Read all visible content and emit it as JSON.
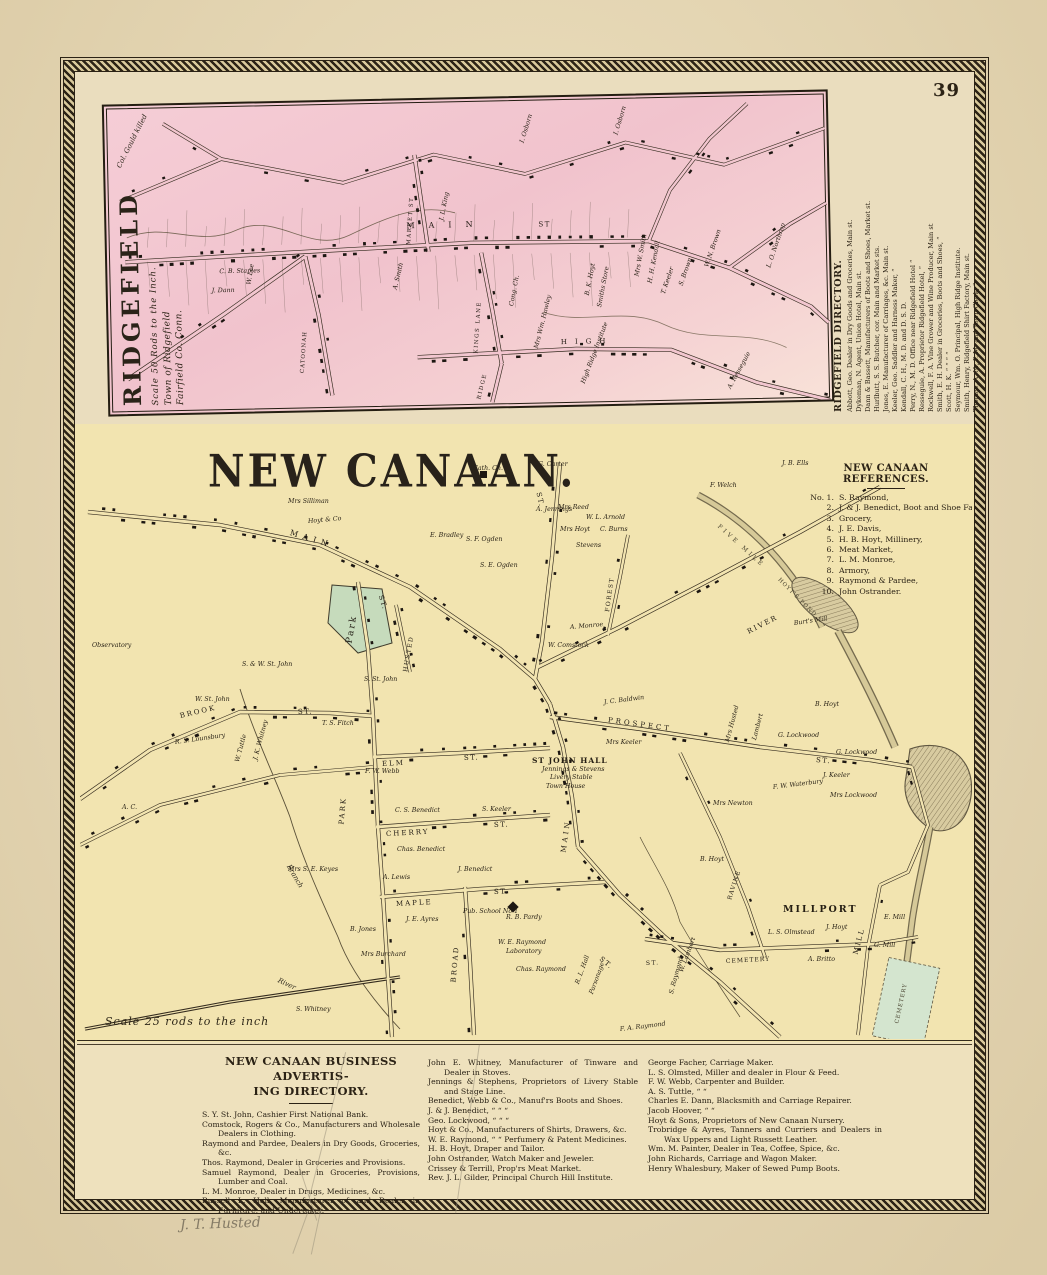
{
  "page": {
    "number": "39",
    "pencil_note": "J. T. Husted"
  },
  "colors": {
    "paper": "#e9dab6",
    "map_cream": "#f2e4b0",
    "ridgefield_pink": "#f2c6cf",
    "ink": "#2b2215",
    "park_green": "#c6dbbc",
    "pond_tan": "#d8cba0",
    "cemetery_green": "#d4e5cf"
  },
  "ridgefield": {
    "title": "RIDGEFIELD",
    "scale_note": "Scale 50 Rods to the Inch.",
    "town_note_line1": "Town of Ridgefield",
    "town_note_line2": "Fairfield Co. Conn.",
    "directory": {
      "title": "RIDGEFIELD DIRECTORY.",
      "entries": [
        "Abbott, Geo. Dealer in Dry Goods and Groceries, Main st.",
        "Dykeman, N. Agent, Union Hotel, Main st.",
        "Dann & Bassett, Manufacturers of Boots and Shoes, Market st.",
        "Hurlbutt, S. S. Butcher, cor. Main and Market sts.",
        "Jones, E. Manufacturer of Carriages, &c. Main st.",
        "Keeler, Geo. Saddler and Harness Maker,  “",
        "Kendall, C. H., M. D. and D. S. D.",
        "Perry, N., M. D. Office near Ridgefield Hotel  “",
        "Resseguie, A. Proprietor Ridgefield Hotel,  “",
        "Rockwell, F. A. Vine Grower and Wine Producer, Main st",
        "Smith, E. H. Dealer in Groceries, Boots and Shoes,  “",
        "Scott, H. K.  “  “  “  “",
        "Seymour, Wm. O. Principal, High Ridge Institute.",
        "Smith, Henry, Ridgefield Shirt Factory, Main st.",
        "Thomas, A. N., P. M. and Town Clerk,  “"
      ]
    },
    "labels": [
      {
        "t": "MAIN",
        "x": 300,
        "y": 122,
        "ls": 14,
        "s": 8,
        "k": "s"
      },
      {
        "t": "ST",
        "x": 432,
        "y": 124,
        "s": 7,
        "k": "s"
      },
      {
        "t": "MARKET ST",
        "x": 303,
        "y": 142,
        "a": -85,
        "s": 5.5,
        "k": "s"
      },
      {
        "t": "CATOONAH",
        "x": 194,
        "y": 268,
        "a": -85,
        "s": 5.5,
        "ls": 1,
        "k": "s"
      },
      {
        "t": "KINGS LANE",
        "x": 368,
        "y": 252,
        "a": -85,
        "s": 5.5,
        "k": "s"
      },
      {
        "t": "HIGH",
        "x": 452,
        "y": 242,
        "s": 7,
        "ls": 8,
        "k": "s"
      },
      {
        "t": "RIDGE",
        "x": 370,
        "y": 298,
        "a": -75,
        "s": 5.5,
        "k": "s"
      },
      {
        "t": "Col. Gould killed",
        "x": 14,
        "y": 58,
        "a": -62,
        "s": 7,
        "k": "c"
      },
      {
        "t": "I. Osborn",
        "x": 418,
        "y": 42,
        "a": -72,
        "k": "p"
      },
      {
        "t": "I. Osborn",
        "x": 512,
        "y": 36,
        "a": -72,
        "k": "p"
      },
      {
        "t": "W. Lee",
        "x": 142,
        "y": 178,
        "a": -80,
        "k": "p"
      },
      {
        "t": "A. Smith",
        "x": 288,
        "y": 186,
        "a": -75,
        "k": "p"
      },
      {
        "t": "C. B. Staples",
        "x": 112,
        "y": 165,
        "k": "p"
      },
      {
        "t": "J. Dann",
        "x": 104,
        "y": 184,
        "k": "p"
      },
      {
        "t": "J. L. King",
        "x": 336,
        "y": 118,
        "a": -78,
        "k": "p"
      },
      {
        "t": "Cong. Ch.",
        "x": 404,
        "y": 205,
        "a": -78,
        "k": "p"
      },
      {
        "t": "Mrs Wm. Hawley",
        "x": 428,
        "y": 248,
        "a": -75,
        "k": "p"
      },
      {
        "t": "Mrs W. Smith",
        "x": 530,
        "y": 178,
        "a": -78,
        "k": "p"
      },
      {
        "t": "H. H. Kendall",
        "x": 543,
        "y": 185,
        "a": -78,
        "k": "p"
      },
      {
        "t": "T. Keeler",
        "x": 556,
        "y": 196,
        "a": -70,
        "k": "p"
      },
      {
        "t": "S. Brown",
        "x": 574,
        "y": 188,
        "a": -70,
        "k": "p"
      },
      {
        "t": "B. K. Hoyt",
        "x": 480,
        "y": 196,
        "a": -78,
        "k": "p"
      },
      {
        "t": "Smiths Store",
        "x": 492,
        "y": 208,
        "a": -78,
        "k": "p"
      },
      {
        "t": "W. N. Brown",
        "x": 600,
        "y": 170,
        "a": -70,
        "k": "p"
      },
      {
        "t": "L. O. Northrop",
        "x": 662,
        "y": 172,
        "a": -70,
        "k": "p"
      },
      {
        "t": "High Ridge Institute",
        "x": 474,
        "y": 284,
        "a": -68,
        "k": "p"
      },
      {
        "t": "A. Resseguie",
        "x": 620,
        "y": 292,
        "a": -60,
        "k": "p"
      }
    ]
  },
  "new_canaan": {
    "title": "NEW CANAAN.",
    "scale_note": "Scale 25 rods to the inch",
    "references": {
      "title": "NEW CANAAN REFERENCES.",
      "entries": [
        [
          "No. 1.",
          "S. Raymond,"
        ],
        [
          "2.",
          "J. & J. Benedict, Boot and Shoe Factory."
        ],
        [
          "3.",
          "Grocery,"
        ],
        [
          "4.",
          "J. E. Davis,"
        ],
        [
          "5.",
          "H. B. Hoyt, Millinery,"
        ],
        [
          "6.",
          "Meat Market,"
        ],
        [
          "7.",
          "L. M. Monroe,"
        ],
        [
          "8.",
          "Armory,"
        ],
        [
          "9.",
          "Raymond & Pardee,"
        ],
        [
          "10.",
          "John Ostrander."
        ]
      ]
    },
    "labels": [
      {
        "t": "MAIN",
        "x": 210,
        "y": 112,
        "a": 17,
        "s": 8,
        "ls": 5,
        "k": "s"
      },
      {
        "t": "ST.",
        "x": 300,
        "y": 175,
        "a": 72,
        "s": 7,
        "k": "s"
      },
      {
        "t": "ST.",
        "x": 458,
        "y": 72,
        "a": 78,
        "s": 7,
        "k": "s"
      },
      {
        "t": "HUSTED",
        "x": 326,
        "y": 252,
        "a": -80,
        "s": 6,
        "k": "s"
      },
      {
        "t": "FOREST",
        "x": 528,
        "y": 192,
        "a": -82,
        "s": 6,
        "k": "s"
      },
      {
        "t": "RIVER",
        "x": 668,
        "y": 212,
        "a": -27,
        "s": 7,
        "ls": 2,
        "k": "s"
      },
      {
        "t": "BROOK",
        "x": 100,
        "y": 296,
        "a": -13,
        "s": 7,
        "ls": 2,
        "k": "s"
      },
      {
        "t": "ST.",
        "x": 218,
        "y": 292,
        "a": -2,
        "s": 7,
        "k": "s"
      },
      {
        "t": "PARK",
        "x": 262,
        "y": 404,
        "a": -85,
        "s": 7,
        "ls": 2,
        "k": "s"
      },
      {
        "t": "ELM",
        "x": 302,
        "y": 344,
        "a": -3,
        "s": 7,
        "ls": 2,
        "k": "s"
      },
      {
        "t": "ST.",
        "x": 384,
        "y": 338,
        "a": -2,
        "s": 7,
        "k": "s"
      },
      {
        "t": "CHERRY",
        "x": 306,
        "y": 414,
        "a": -3,
        "s": 7,
        "ls": 2,
        "k": "s"
      },
      {
        "t": "ST.",
        "x": 414,
        "y": 405,
        "a": -2,
        "s": 7,
        "k": "s"
      },
      {
        "t": "MAPLE",
        "x": 316,
        "y": 484,
        "a": -3,
        "s": 7,
        "ls": 2,
        "k": "s"
      },
      {
        "t": "ST.",
        "x": 414,
        "y": 472,
        "a": -2,
        "s": 7,
        "k": "s"
      },
      {
        "t": "BROAD",
        "x": 374,
        "y": 562,
        "a": -85,
        "s": 7,
        "ls": 2,
        "k": "s"
      },
      {
        "t": "MAIN",
        "x": 484,
        "y": 432,
        "a": -82,
        "s": 7,
        "ls": 3,
        "k": "s"
      },
      {
        "t": "ST.",
        "x": 520,
        "y": 538,
        "a": 40,
        "s": 7,
        "k": "s"
      },
      {
        "t": "PROSPECT",
        "x": 528,
        "y": 300,
        "a": 8,
        "s": 7,
        "ls": 3,
        "k": "s"
      },
      {
        "t": "ST.",
        "x": 736,
        "y": 340,
        "a": 5,
        "s": 7,
        "k": "s"
      },
      {
        "t": "RAVINE",
        "x": 650,
        "y": 480,
        "a": -72,
        "s": 6,
        "ls": 1,
        "k": "s"
      },
      {
        "t": "CEMETERY",
        "x": 646,
        "y": 542,
        "a": -3,
        "s": 6,
        "ls": 1,
        "k": "s"
      },
      {
        "t": "ST.",
        "x": 566,
        "y": 544,
        "a": -3,
        "s": 6,
        "k": "s"
      },
      {
        "t": "MILL",
        "x": 776,
        "y": 534,
        "a": -75,
        "s": 7,
        "ls": 2,
        "k": "s"
      },
      {
        "t": "FIVE MILE",
        "x": 638,
        "y": 106,
        "a": 42,
        "s": 6,
        "ls": 3,
        "k": "w"
      },
      {
        "t": "HOYT'S POND",
        "x": 698,
        "y": 160,
        "a": 45,
        "s": 5.5,
        "ls": 1,
        "k": "w"
      },
      {
        "t": "CEMETERY",
        "x": 818,
        "y": 604,
        "a": -78,
        "s": 5.5,
        "ls": 1,
        "k": "w"
      },
      {
        "t": "ST JOHN HALL",
        "x": 452,
        "y": 340,
        "s": 7.5,
        "k": "b"
      },
      {
        "t": "MILLPORT",
        "x": 703,
        "y": 488,
        "s": 9.5,
        "ls": 2,
        "k": "b"
      },
      {
        "t": "Branch",
        "x": 208,
        "y": 445,
        "a": 60,
        "k": "c"
      },
      {
        "t": "River",
        "x": 198,
        "y": 560,
        "a": 25,
        "k": "c"
      },
      {
        "t": "Park",
        "x": 270,
        "y": 222,
        "a": -80,
        "s": 9,
        "ls": 2,
        "k": "s"
      },
      {
        "t": "Mrs Silliman",
        "x": 208,
        "y": 82,
        "k": "p"
      },
      {
        "t": "Cath. Ch.",
        "x": 393,
        "y": 49,
        "k": "p"
      },
      {
        "t": "G. Carter",
        "x": 458,
        "y": 45,
        "k": "p"
      },
      {
        "t": "A. Jennings",
        "x": 456,
        "y": 90,
        "k": "p"
      },
      {
        "t": "Mrs Reed",
        "x": 478,
        "y": 88,
        "k": "p"
      },
      {
        "t": "W. L. Arnold",
        "x": 506,
        "y": 98,
        "k": "p"
      },
      {
        "t": "Mrs Hoyt",
        "x": 480,
        "y": 110,
        "k": "p"
      },
      {
        "t": "C. Burns",
        "x": 520,
        "y": 110,
        "k": "p"
      },
      {
        "t": "Stevens",
        "x": 496,
        "y": 126,
        "k": "p"
      },
      {
        "t": "Hoyt & Co",
        "x": 228,
        "y": 102,
        "a": -5,
        "k": "p"
      },
      {
        "t": "E. Bradley",
        "x": 350,
        "y": 116,
        "k": "p"
      },
      {
        "t": "S. F. Ogden",
        "x": 386,
        "y": 120,
        "k": "p"
      },
      {
        "t": "S. E. Ogden",
        "x": 400,
        "y": 146,
        "k": "p"
      },
      {
        "t": "A. Monroe",
        "x": 490,
        "y": 208,
        "a": -5,
        "k": "p"
      },
      {
        "t": "W. Comstock",
        "x": 468,
        "y": 226,
        "k": "p"
      },
      {
        "t": "J. B. Ells",
        "x": 702,
        "y": 44,
        "k": "p"
      },
      {
        "t": "F. Welch",
        "x": 630,
        "y": 66,
        "k": "p"
      },
      {
        "t": "Burt's Mill",
        "x": 714,
        "y": 204,
        "a": -8,
        "k": "p"
      },
      {
        "t": "Observatory",
        "x": 12,
        "y": 226,
        "k": "p"
      },
      {
        "t": "S. & W. St. John",
        "x": 162,
        "y": 245,
        "k": "p"
      },
      {
        "t": "W. St. John",
        "x": 115,
        "y": 280,
        "k": "p"
      },
      {
        "t": "S. St. John",
        "x": 284,
        "y": 260,
        "k": "p"
      },
      {
        "t": "T. S. Fitch",
        "x": 242,
        "y": 304,
        "k": "p"
      },
      {
        "t": "R. S. Lounsbury",
        "x": 95,
        "y": 323,
        "a": -8,
        "k": "p"
      },
      {
        "t": "W. Tuttle",
        "x": 158,
        "y": 342,
        "a": -75,
        "k": "p"
      },
      {
        "t": "J. K. Whitney",
        "x": 176,
        "y": 340,
        "a": -75,
        "k": "p"
      },
      {
        "t": "Mrs S. E. Keyes",
        "x": 208,
        "y": 450,
        "k": "p"
      },
      {
        "t": "A. C.",
        "x": 42,
        "y": 388,
        "k": "p"
      },
      {
        "t": "Jennings & Stevens",
        "x": 462,
        "y": 350,
        "k": "p"
      },
      {
        "t": "Livery Stable",
        "x": 470,
        "y": 358,
        "k": "p"
      },
      {
        "t": "Town House",
        "x": 466,
        "y": 367,
        "k": "p"
      },
      {
        "t": "S. Keeler",
        "x": 402,
        "y": 390,
        "k": "p"
      },
      {
        "t": "C. S. Benedict",
        "x": 315,
        "y": 391,
        "k": "p"
      },
      {
        "t": "F. W. Webb",
        "x": 285,
        "y": 352,
        "k": "p"
      },
      {
        "t": "Chas. Benedict",
        "x": 317,
        "y": 430,
        "k": "p"
      },
      {
        "t": "J. Benedict",
        "x": 378,
        "y": 450,
        "k": "p"
      },
      {
        "t": "A. Lewis",
        "x": 303,
        "y": 458,
        "k": "p"
      },
      {
        "t": "J. E. Ayres",
        "x": 326,
        "y": 500,
        "k": "p"
      },
      {
        "t": "B. Jones",
        "x": 270,
        "y": 510,
        "k": "p"
      },
      {
        "t": "Mrs Burchard",
        "x": 281,
        "y": 535,
        "k": "p"
      },
      {
        "t": "Pub. School No 1",
        "x": 383,
        "y": 492,
        "k": "p"
      },
      {
        "t": "R. B. Pardy",
        "x": 426,
        "y": 498,
        "k": "p"
      },
      {
        "t": "W. E. Raymond",
        "x": 418,
        "y": 523,
        "k": "p"
      },
      {
        "t": "Laboratory",
        "x": 426,
        "y": 532,
        "k": "p"
      },
      {
        "t": "Chas. Raymond",
        "x": 436,
        "y": 550,
        "k": "p"
      },
      {
        "t": "R. L. Hall",
        "x": 498,
        "y": 564,
        "a": -70,
        "k": "p"
      },
      {
        "t": "Parsonage",
        "x": 512,
        "y": 574,
        "a": -70,
        "k": "p"
      },
      {
        "t": "S. Raymond",
        "x": 592,
        "y": 574,
        "a": -75,
        "k": "p"
      },
      {
        "t": "W. Lambert",
        "x": 602,
        "y": 552,
        "a": -70,
        "k": "p"
      },
      {
        "t": "F. A. Raymond",
        "x": 540,
        "y": 610,
        "a": -7,
        "k": "p"
      },
      {
        "t": "J. C. Baldwin",
        "x": 524,
        "y": 283,
        "a": -7,
        "k": "p"
      },
      {
        "t": "Mrs Keeler",
        "x": 526,
        "y": 323,
        "k": "p"
      },
      {
        "t": "Mrs Husted",
        "x": 648,
        "y": 322,
        "a": -75,
        "k": "p"
      },
      {
        "t": "Lambert",
        "x": 675,
        "y": 320,
        "a": -75,
        "k": "p"
      },
      {
        "t": "B. Hoyt",
        "x": 735,
        "y": 285,
        "k": "p"
      },
      {
        "t": "G. Lockwood",
        "x": 698,
        "y": 316,
        "k": "p"
      },
      {
        "t": "G. Lockwood",
        "x": 756,
        "y": 333,
        "k": "p"
      },
      {
        "t": "J. Keeler",
        "x": 743,
        "y": 356,
        "k": "p"
      },
      {
        "t": "Mrs Lockwood",
        "x": 750,
        "y": 376,
        "k": "p"
      },
      {
        "t": "F. W. Waterbury",
        "x": 693,
        "y": 368,
        "a": -7,
        "k": "p"
      },
      {
        "t": "Mrs Newton",
        "x": 633,
        "y": 384,
        "k": "p"
      },
      {
        "t": "B. Hoyt",
        "x": 620,
        "y": 440,
        "k": "p"
      },
      {
        "t": "L. S. Olmstead",
        "x": 688,
        "y": 513,
        "k": "p"
      },
      {
        "t": "J. Hoyt",
        "x": 746,
        "y": 508,
        "k": "p"
      },
      {
        "t": "A. Britto",
        "x": 728,
        "y": 540,
        "k": "p"
      },
      {
        "t": "E. Mill",
        "x": 804,
        "y": 498,
        "k": "p"
      },
      {
        "t": "G. Mill",
        "x": 794,
        "y": 526,
        "k": "p"
      },
      {
        "t": "S. Whitney",
        "x": 216,
        "y": 590,
        "k": "p"
      }
    ]
  },
  "business_directory": {
    "title_line1": "NEW CANAAN BUSINESS ADVERTIS-",
    "title_line2": "ING DIRECTORY.",
    "columns": {
      "col1": [
        "S. Y. St. John, Cashier First National Bank.",
        "Comstock, Rogers & Co., Manufacturers and Wholesale Dealers in Clothing.",
        "Raymond and Pardee, Dealers in Dry Goods, Groceries, &c.",
        "Thos. Raymond, Dealer in Groceries and Provisions.",
        "Samuel Raymond, Dealer in Groceries, Provisions, Lumber and Coal.",
        "L. M. Monroe, Dealer in Drugs, Medicines, &c.",
        "Russell L. Hall, Manufacturer of and Dealer in Furniture, and Undertaker."
      ],
      "col2": [
        "John E. Whitney, Manufacturer of Tinware and Dealer in Stoves.",
        "Jennings & Stephens, Proprietors of Livery Stable and Stage Line.",
        "Benedict, Webb & Co., Manuf'rs Boots and Shoes.",
        "J. & J. Benedict,    “    “    “",
        "Geo. Lockwood,    “    “    “",
        "Hoyt & Co., Manufacturers of Shirts, Drawers, &c.",
        "W. E. Raymond,  “  “ Perfumery & Patent Medicines.",
        "H. B. Hoyt, Draper and Tailor.",
        "John Ostrander, Watch Maker and Jeweler.",
        "Crissey & Terrill, Prop'rs Meat Market.",
        "Rev. J. L. Gilder, Principal Church Hill Institute."
      ],
      "col3": [
        "George Facher, Carriage Maker.",
        "L. S. Olmsted, Miller and dealer in Flour & Feed.",
        "F. W. Webb, Carpenter and Builder.",
        "A. S. Tuttle,    “    “",
        "Charles E. Dann, Blacksmith and Carriage Repairer.",
        "Jacob Hoover,    “    “",
        "Hoyt & Sons, Proprietors of New Canaan Nursery.",
        "Trobridge & Ayres, Tanners and Curriers and Dealers in Wax Uppers and Light Russett Leather.",
        "Wm. M. Painter, Dealer in Tea, Coffee, Spice, &c.",
        "John Richards, Carriage and Wagon Maker.",
        "Henry Whalesbury, Maker of Sewed Pump Boots."
      ]
    }
  }
}
